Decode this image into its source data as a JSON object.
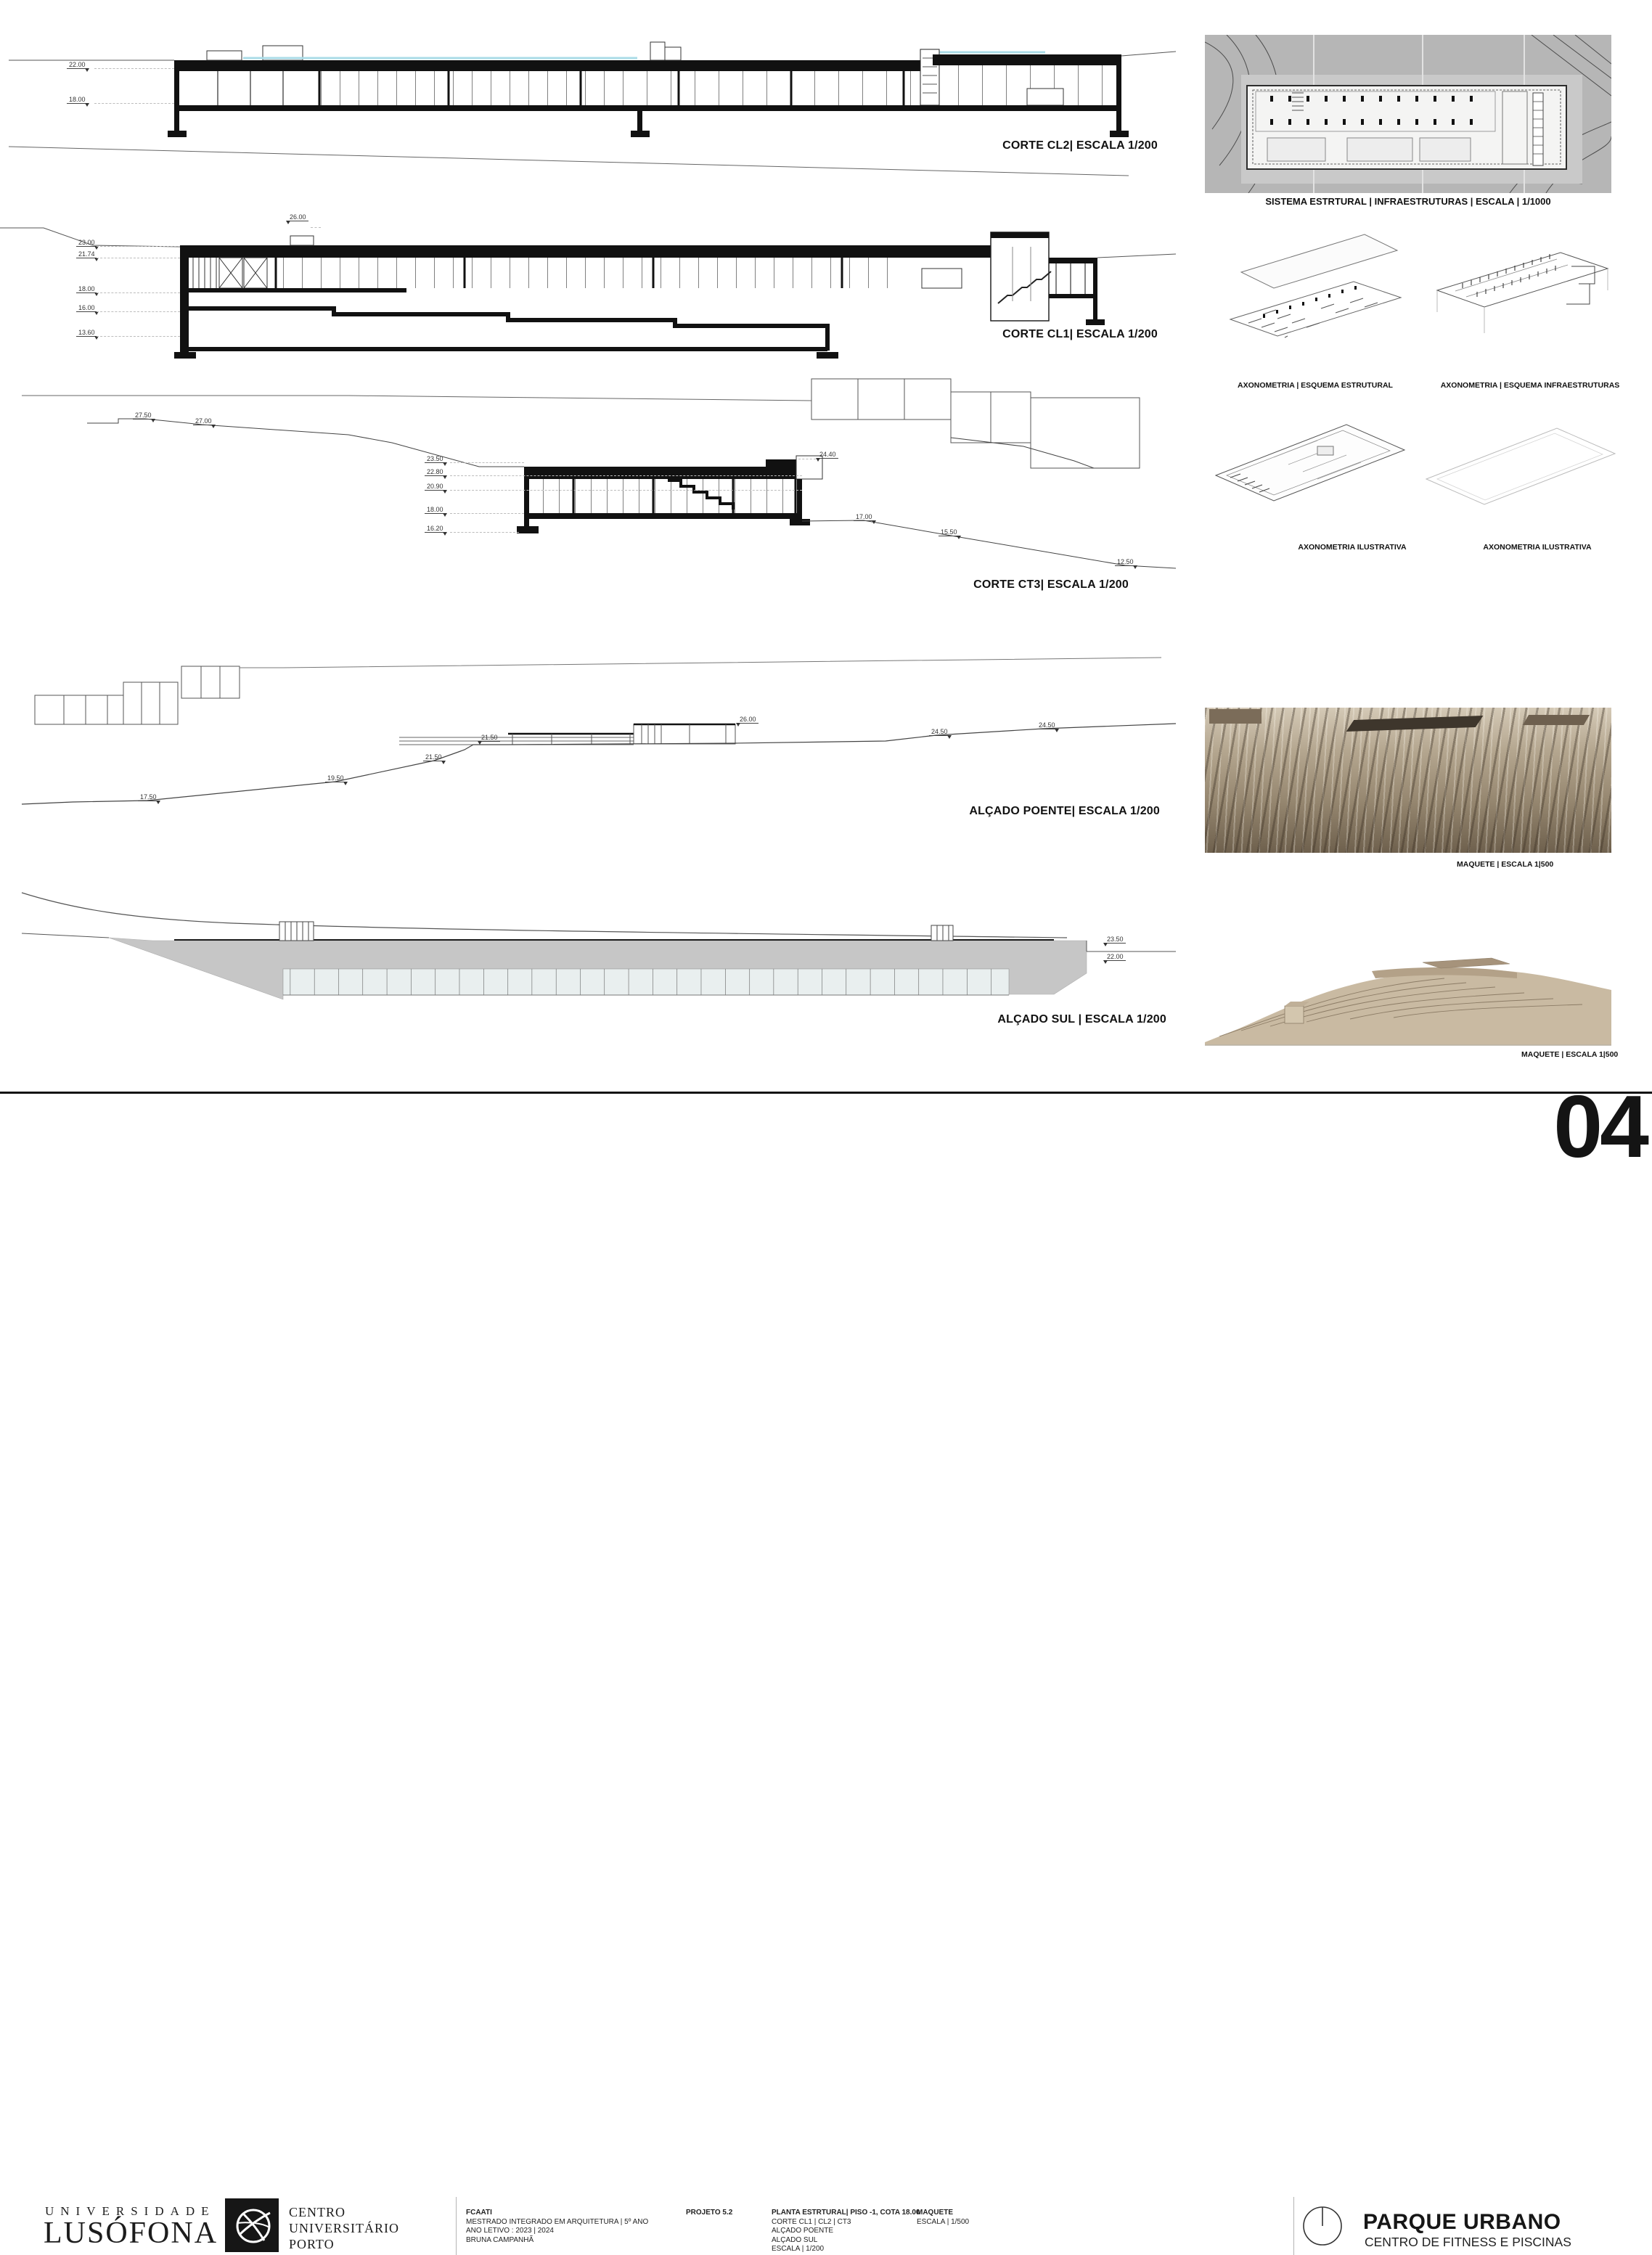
{
  "drawings": {
    "corte_cl2": {
      "label": "CORTE CL2| ESCALA 1/200",
      "marks": [
        "22.00",
        "18.00"
      ]
    },
    "corte_cl1": {
      "label": "CORTE CL1| ESCALA 1/200",
      "top_mark": "26.00",
      "marks": [
        "23.00",
        "21.74",
        "18.00",
        "16.00",
        "13.60"
      ]
    },
    "corte_ct3": {
      "label": "CORTE CT3| ESCALA 1/200",
      "top_mark": "24.40",
      "marks": [
        "23.50",
        "22.80",
        "20.90",
        "18.00",
        "16.20"
      ],
      "terrain_marks": [
        "27.50",
        "27.00",
        "17.00",
        "15.50",
        "12.50"
      ]
    },
    "alcado_poente": {
      "label": "ALÇADO POENTE| ESCALA 1/200",
      "terrain_marks": [
        "17.50",
        "19.50",
        "21.50",
        "21.50",
        "26.00",
        "24.50",
        "24.50"
      ]
    },
    "alcado_sul": {
      "label": "ALÇADO SUL | ESCALA 1/200",
      "marks": [
        "23.50",
        "22.00"
      ]
    }
  },
  "side_panels": {
    "sistema": {
      "label": "SISTEMA ESTRTURAL | INFRAESTRUTURAS | ESCALA | 1/1000"
    },
    "axo_estrutural": {
      "label": "AXONOMETRIA | ESQUEMA ESTRUTURAL"
    },
    "axo_infra": {
      "label": "AXONOMETRIA | ESQUEMA INFRAESTRUTURAS"
    },
    "axo_ilustrativa_1": {
      "label": "AXONOMETRIA ILUSTRATIVA"
    },
    "axo_ilustrativa_2": {
      "label": "AXONOMETRIA ILUSTRATIVA"
    },
    "maquete_1": {
      "label": "MAQUETE | ESCALA 1|500"
    },
    "maquete_2": {
      "label": "MAQUETE | ESCALA 1|500"
    }
  },
  "footer": {
    "university_line1": "UNIVERSIDADE",
    "university_line2": "LUSÓFONA",
    "center_lines": [
      "CENTRO",
      "UNIVERSITÁRIO",
      "PORTO"
    ],
    "course": {
      "title": "FCAATI",
      "line1": "MESTRADO INTEGRADO EM ARQUITETURA | 5º ANO",
      "line2": "ANO LETIVO : 2023 | 2024",
      "line3": "BRUNA CAMPANHÃ"
    },
    "project": "PROJETO 5.2",
    "sheet_contents": {
      "title": "PLANTA ESTRTURAL|  PISO -1, COTA 18.00",
      "line1": "CORTE CL1 | CL2 | CT3",
      "line2": "ALÇADO POENTE",
      "line3": "ALÇADO SUL",
      "line4": "ESCALA |  1/200"
    },
    "model": {
      "title": "MAQUETE",
      "line1": "ESCALA | 1/500"
    },
    "project_title": "PARQUE URBANO",
    "project_subtitle": "CENTRO DE FITNESS E PISCINAS",
    "sheet_number": "04"
  },
  "colors": {
    "accent_blue": "#a9dbe7",
    "concrete_gray": "#c6c6c6",
    "model_tan": "#a3947f",
    "ink": "#1a1a1a"
  }
}
